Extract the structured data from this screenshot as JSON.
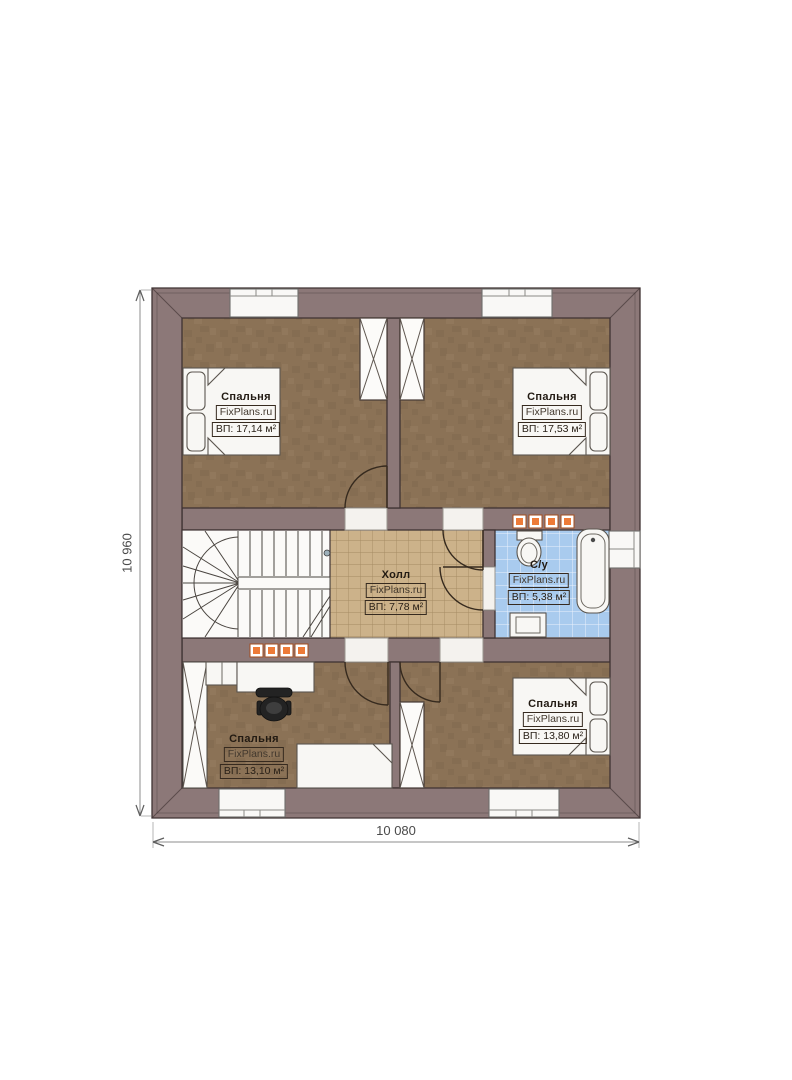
{
  "plan": {
    "watermark_brand": "FixPlans.ru",
    "rooms": [
      {
        "id": "bedroom-top-left",
        "name": "Спальня",
        "watermark": "FixPlans.ru",
        "area": "ВП: 17,14 м²"
      },
      {
        "id": "bedroom-top-right",
        "name": "Спальня",
        "watermark": "FixPlans.ru",
        "area": "ВП: 17,53 м²"
      },
      {
        "id": "hall",
        "name": "Холл",
        "watermark": "FixPlans.ru",
        "area": "ВП: 7,78 м²"
      },
      {
        "id": "bathroom",
        "name": "С/у",
        "watermark": "FixPlans.ru",
        "area": "ВП: 5,38 м²"
      },
      {
        "id": "bedroom-bottom-left",
        "name": "Спальня",
        "watermark": "FixPlans.ru",
        "area": "ВП: 13,10 м²"
      },
      {
        "id": "bedroom-bottom-right",
        "name": "Спальня",
        "watermark": "FixPlans.ru",
        "area": "ВП: 13,80 м²"
      }
    ],
    "dimensions": {
      "height_label": "10 960",
      "width_label": "10 080"
    },
    "colors": {
      "wall": "#8c7878",
      "wall_line": "#3f3333",
      "floor_bedroom": "#8b7256",
      "floor_hall": "#ccb28a",
      "floor_bath": "#a9cbee",
      "radiator": "#ed7b38",
      "background": "#ffffff"
    }
  }
}
